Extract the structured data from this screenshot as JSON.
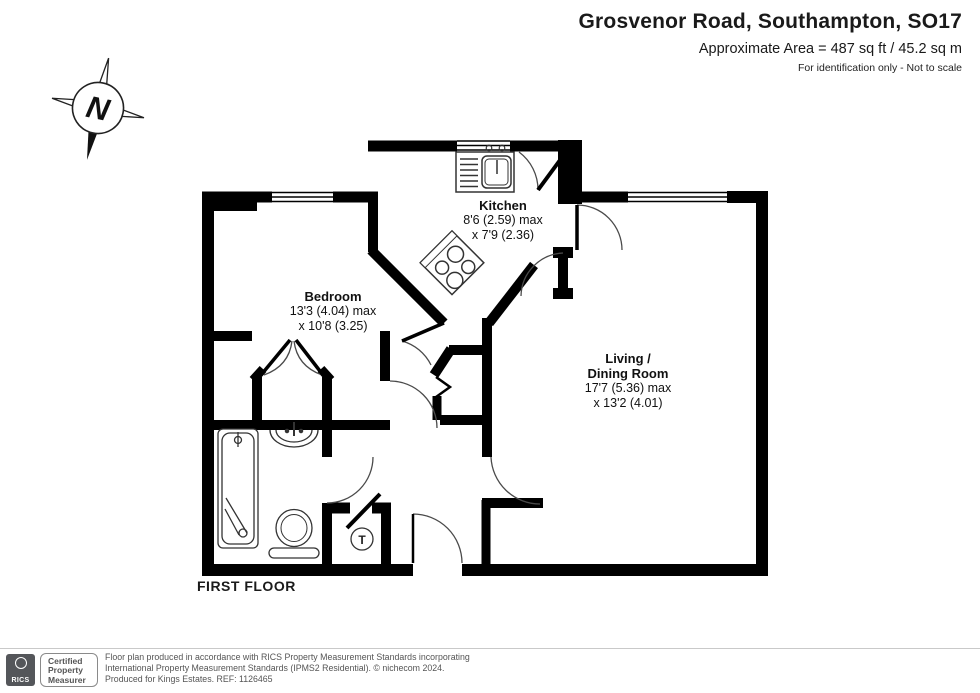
{
  "header": {
    "title": "Grosvenor Road, Southampton, SO17",
    "area_line": "Approximate Area = 487 sq ft / 45.2 sq m",
    "note": "For identification only - Not to scale"
  },
  "compass": {
    "letter": "N"
  },
  "floor_label": "FIRST FLOOR",
  "rooms": {
    "kitchen": {
      "name": "Kitchen",
      "dim1": "8'6 (2.59) max",
      "dim2": "x 7'9 (2.36)"
    },
    "bedroom": {
      "name": "Bedroom",
      "dim1": "13'3 (4.04) max",
      "dim2": "x 10'8 (3.25)"
    },
    "living": {
      "name1": "Living /",
      "name2": "Dining Room",
      "dim1": "17'7 (5.36) max",
      "dim2": "x 13'2 (4.01)"
    }
  },
  "fixtures": {
    "tank_label": "T"
  },
  "footer": {
    "rics_brand": "RICS",
    "cert_line1": "Certified",
    "cert_line2": "Property",
    "cert_line3": "Measurer",
    "line1": "Floor plan produced in accordance with RICS Property Measurement Standards incorporating",
    "line2": "International Property Measurement Standards (IPMS2 Residential).  © nichecom 2024.",
    "line3": "Produced for Kings Estates.   REF:  1126465"
  },
  "colors": {
    "wall": "#000000",
    "logo_bg": "#54565a",
    "text": "#1a1a1a",
    "muted": "#555555"
  }
}
